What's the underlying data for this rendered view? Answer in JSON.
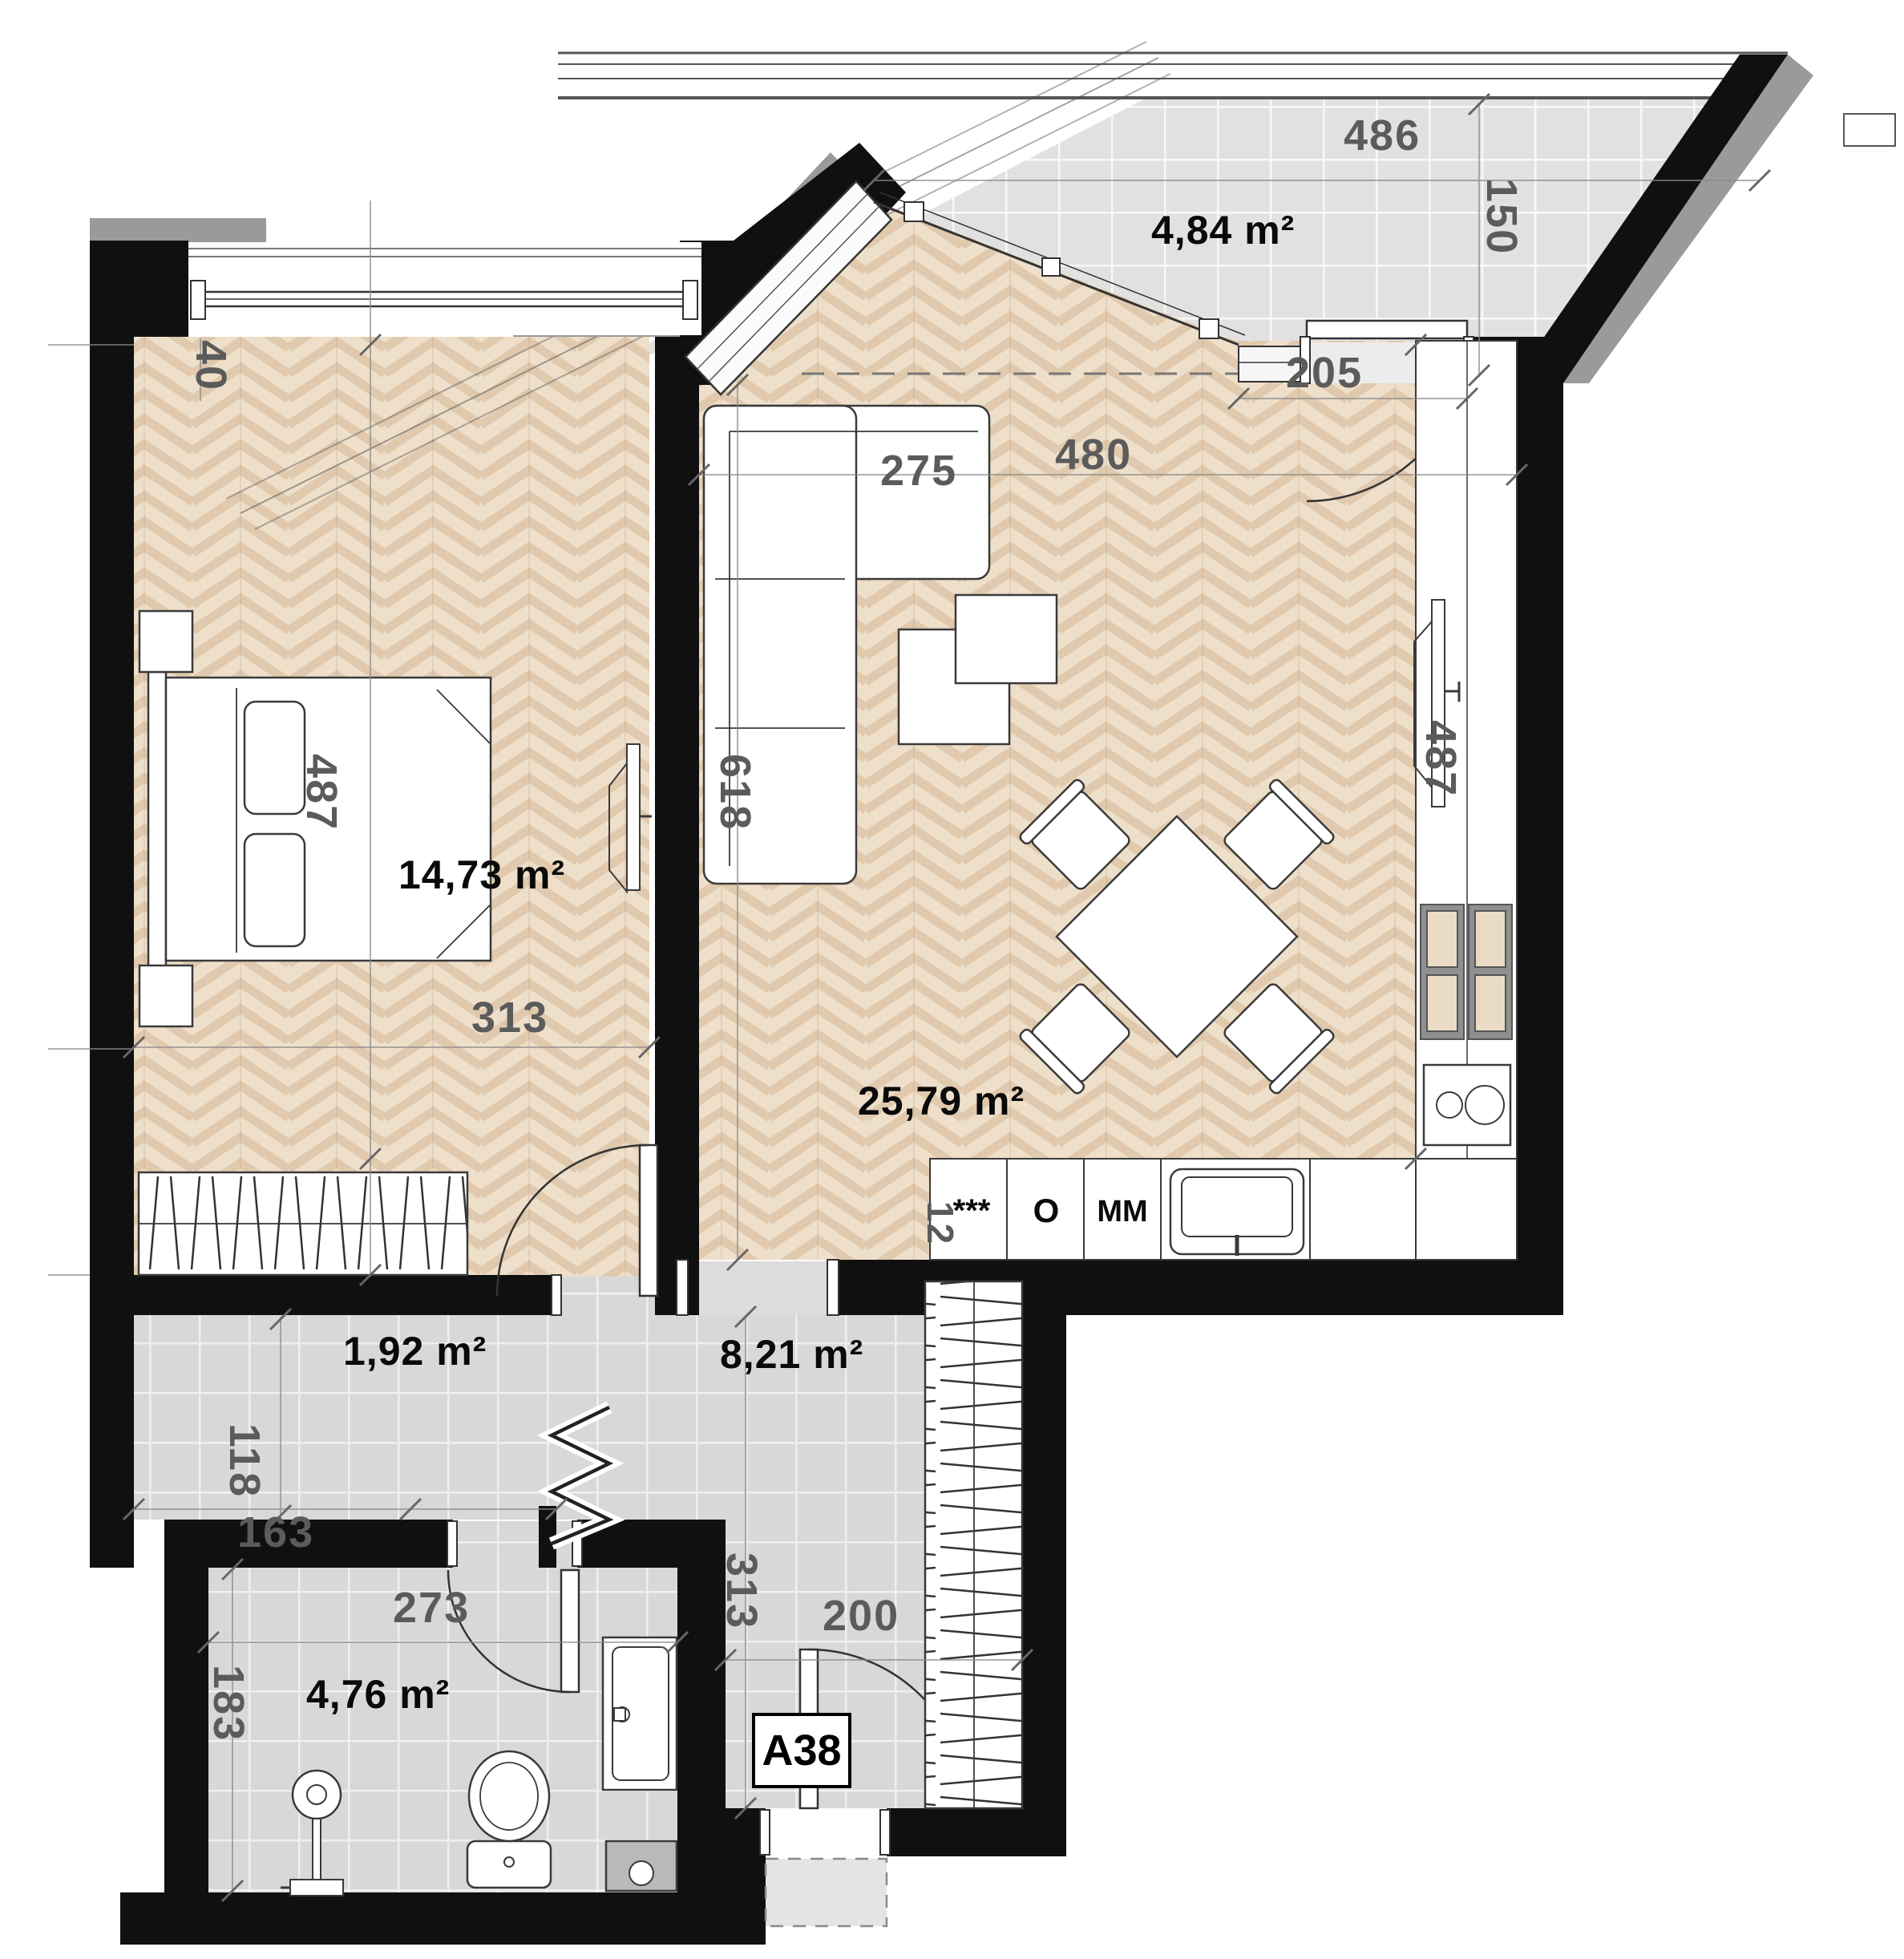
{
  "plan": {
    "unit_label": "A38",
    "rooms": {
      "bedroom": {
        "area": "14,73 m²"
      },
      "living_kitchen": {
        "area": "25,79 m²"
      },
      "balcony": {
        "area": "4,84 m²"
      },
      "hallway": {
        "area": "8,21 m²"
      },
      "closet": {
        "area": "1,92 m²"
      },
      "bathroom": {
        "area": "4,76 m²"
      }
    },
    "dimensions": {
      "d40": "40",
      "d487_bedroom": "487",
      "d313_bedroom": "313",
      "d275": "275",
      "d618": "618",
      "d480": "480",
      "d205": "205",
      "d486": "486",
      "d150": "150",
      "d487_kitchen": "487",
      "d12": "12",
      "d118": "118",
      "d163": "163",
      "d313_hallway": "313",
      "d200": "200",
      "d273": "273",
      "d183": "183"
    },
    "kitchen_labels": {
      "dishwasher": "***",
      "oven": "O",
      "microwave": "MM"
    },
    "colors": {
      "wall": "#101010",
      "parquet": "#eedfca",
      "parquet_stripe": "#e0c9ad",
      "tile": "#d8d8d8",
      "balcony_tile": "#e0e0e0",
      "dim_text": "#5b5b5b",
      "gray_cap": "#9a9a9a"
    }
  }
}
